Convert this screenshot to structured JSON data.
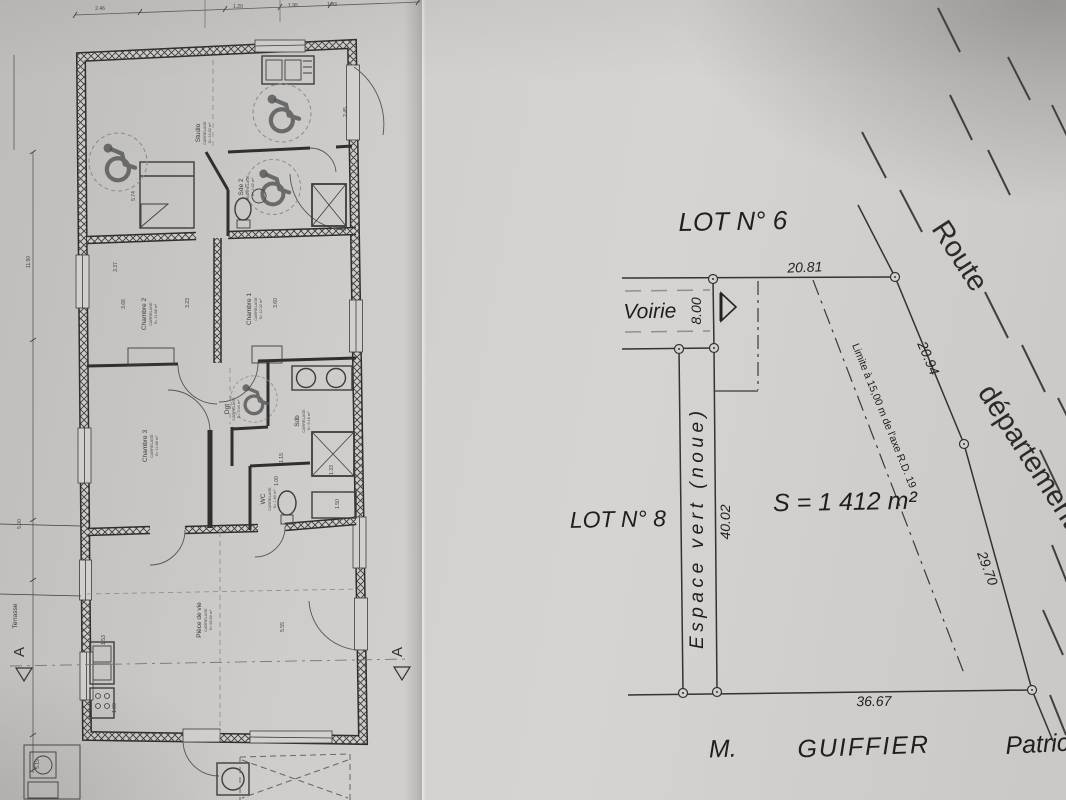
{
  "colors": {
    "paper": "#d2d0ce",
    "ink": "#333333"
  },
  "plot_plan": {
    "lot6_label": "LOT N° 6",
    "lot8_label": "LOT N° 8",
    "voirie_label": "Voirie",
    "espace_vert_label": "Espace vert (noue)",
    "surface_label": "S = 1 412 m²",
    "limite_label": "Limite à 15,00 m de l'axe R.D. 19",
    "route_word1": "Route",
    "route_word2": "départementale",
    "owner_title": "M.",
    "owner_last_name": "GUIFFIER",
    "owner_first_name": "Patrick",
    "dim_top": "20.81",
    "dim_access_width": "8.00",
    "dim_west": "40.02",
    "dim_south": "36.67",
    "dim_road_upper": "20.94",
    "dim_road_lower": "29.70"
  },
  "floor_plan": {
    "section_letter": "A",
    "rooms": [
      {
        "name": "Studio",
        "finish": "CARRELAGE",
        "area": "S= 24.62 m²"
      },
      {
        "name": "Sde 2",
        "finish": "CARRELAGE",
        "area": "S= 4.62 m²"
      },
      {
        "name": "Chambre 2",
        "finish": "CARRELAGE",
        "area": "S= 11.88 m²"
      },
      {
        "name": "Chambre 1",
        "finish": "CARRELAGE",
        "area": "S= 12.02 m²"
      },
      {
        "name": "Chambre 3",
        "finish": "CARRELAGE",
        "area": "S= 11.88 m²"
      },
      {
        "name": "Dgt",
        "finish": "CARRELAGE",
        "area": "S= 5.04 m²"
      },
      {
        "name": "Sdb",
        "finish": "CARRELAGE",
        "area": "S= 5.18 m²"
      },
      {
        "name": "WC",
        "finish": "CARRELAGE",
        "area": "S= 1.80 m²"
      },
      {
        "name": "Pièce de vie",
        "finish": "CARRELAGE",
        "area": "S= 58.50 m²"
      },
      {
        "name": "Terrasse",
        "finish": "",
        "area": ""
      }
    ],
    "dims": [
      "11.50",
      "5.00",
      "5.19",
      "3.37",
      "3.66",
      "3.23",
      "3.60",
      "2.45",
      "5.74",
      "5.55",
      "1.53",
      "1.15",
      "1.33",
      "1.50",
      "1.00",
      "1.00",
      "2.46",
      "1.20",
      "1.95",
      "1.43"
    ]
  }
}
